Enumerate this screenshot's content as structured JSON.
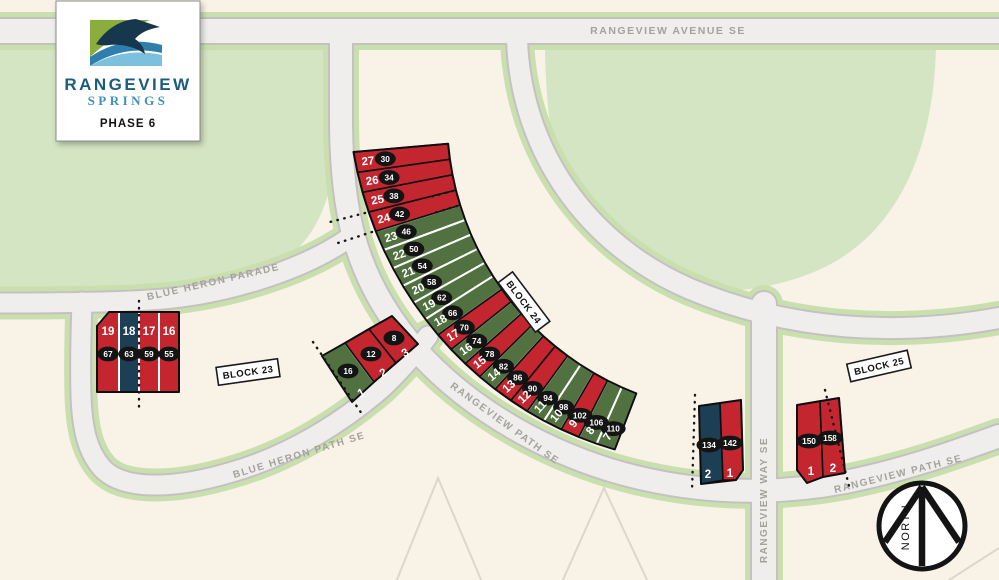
{
  "brand": {
    "name_top": "RANGEVIEW",
    "name_bottom": "SPRINGS",
    "phase": "PHASE 6"
  },
  "streets": {
    "avenue": "RANGEVIEW AVENUE SE",
    "parade": "BLUE HERON PARADE",
    "heron_path": "BLUE HERON PATH SE",
    "path": "RANGEVIEW PATH SE",
    "way": "RANGEVIEW WAY SE"
  },
  "blocks": {
    "b23": "BLOCK 23",
    "b24": "BLOCK 24",
    "b25": "BLOCK 25"
  },
  "north_label": "NORTH",
  "colors": {
    "lot_red": "#c42630",
    "lot_green": "#517140",
    "lot_navy": "#1d3f56"
  },
  "lot_groups": [
    {
      "name": "block24-arc",
      "lots": [
        {
          "lot": "27",
          "address": "30",
          "status": "red"
        },
        {
          "lot": "26",
          "address": "34",
          "status": "red"
        },
        {
          "lot": "25",
          "address": "38",
          "status": "red"
        },
        {
          "lot": "24",
          "address": "42",
          "status": "red"
        },
        {
          "lot": "23",
          "address": "46",
          "status": "green"
        },
        {
          "lot": "22",
          "address": "50",
          "status": "green"
        },
        {
          "lot": "21",
          "address": "54",
          "status": "green"
        },
        {
          "lot": "20",
          "address": "58",
          "status": "green"
        },
        {
          "lot": "19",
          "address": "62",
          "status": "green"
        },
        {
          "lot": "18",
          "address": "66",
          "status": "green"
        },
        {
          "lot": "17",
          "address": "70",
          "status": "red"
        },
        {
          "lot": "16",
          "address": "74",
          "status": "green"
        },
        {
          "lot": "15",
          "address": "78",
          "status": "red"
        },
        {
          "lot": "14",
          "address": "82",
          "status": "green"
        },
        {
          "lot": "13",
          "address": "86",
          "status": "red"
        },
        {
          "lot": "12",
          "address": "90",
          "status": "red"
        },
        {
          "lot": "11",
          "address": "94",
          "status": "green"
        },
        {
          "lot": "10",
          "address": "98",
          "status": "green"
        },
        {
          "lot": "9",
          "address": "102",
          "status": "red"
        },
        {
          "lot": "8",
          "address": "106",
          "status": "green"
        },
        {
          "lot": "7",
          "address": "110",
          "status": "green"
        }
      ]
    },
    {
      "name": "block23-west",
      "lots": [
        {
          "lot": "19",
          "address": "67",
          "status": "red"
        },
        {
          "lot": "18",
          "address": "63",
          "status": "navy"
        },
        {
          "lot": "17",
          "address": "59",
          "status": "red"
        },
        {
          "lot": "16",
          "address": "55",
          "status": "red"
        }
      ]
    },
    {
      "name": "block23-east",
      "lots": [
        {
          "lot": "1",
          "address": "16",
          "status": "green"
        },
        {
          "lot": "2",
          "address": "12",
          "status": "red"
        },
        {
          "lot": "3",
          "address": "8",
          "status": "red"
        }
      ]
    },
    {
      "name": "way-west",
      "lots": [
        {
          "lot": "2",
          "address": "134",
          "status": "navy"
        },
        {
          "lot": "1",
          "address": "142",
          "status": "red"
        }
      ]
    },
    {
      "name": "way-east",
      "lots": [
        {
          "lot": "1",
          "address": "150",
          "status": "red"
        },
        {
          "lot": "2",
          "address": "158",
          "status": "red"
        }
      ]
    }
  ]
}
